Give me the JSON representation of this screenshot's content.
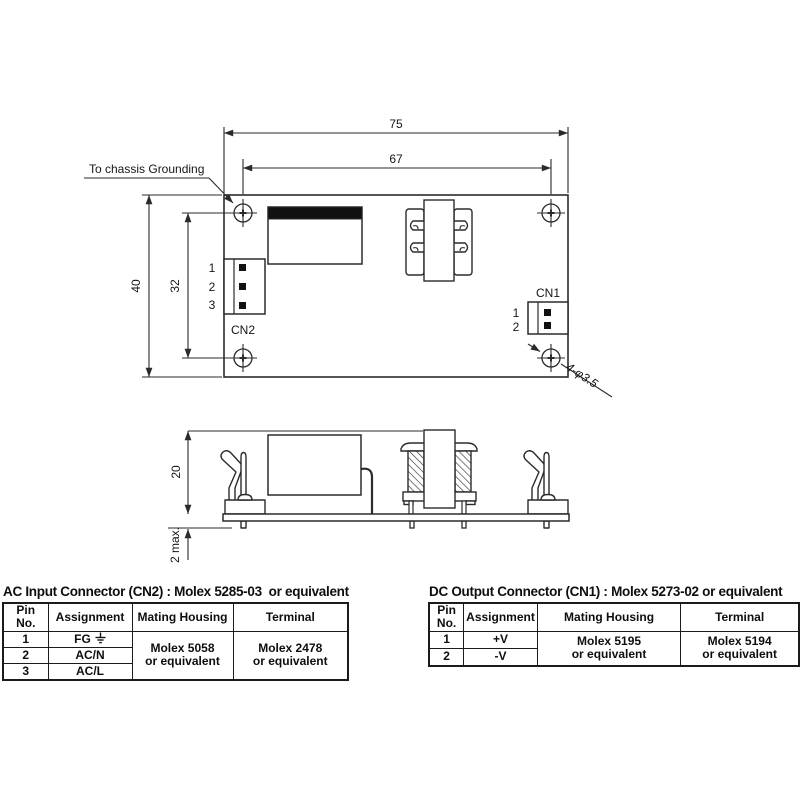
{
  "colors": {
    "line": "#2b2b2b",
    "background": "#ffffff",
    "fill_black": "#111111"
  },
  "top_view": {
    "dims": {
      "outer_width": "75",
      "inner_width": "67",
      "outer_height": "40",
      "inner_height": "32"
    },
    "grounding_label": "To chassis Grounding",
    "holes_label": "4-φ3.5",
    "cn2": {
      "label": "CN2",
      "pins": [
        "1",
        "2",
        "3"
      ]
    },
    "cn1": {
      "label": "CN1",
      "pins": [
        "1",
        "2"
      ]
    }
  },
  "side_view": {
    "dims": {
      "height": "20",
      "pin_protrusion": "2 max."
    }
  },
  "tables": {
    "ac": {
      "title": "AC Input Connector (CN2) : Molex 5285-03  or equivalent",
      "headers": [
        "Pin No.",
        "Assignment",
        "Mating Housing",
        "Terminal"
      ],
      "rows": [
        {
          "pin": "1",
          "assignment": "FG",
          "has_ground_icon": true
        },
        {
          "pin": "2",
          "assignment": "AC/N"
        },
        {
          "pin": "3",
          "assignment": "AC/L"
        }
      ],
      "mating_housing": [
        "Molex 5058",
        "or equivalent"
      ],
      "terminal": [
        "Molex 2478",
        "or equivalent"
      ]
    },
    "dc": {
      "title": "DC Output Connector (CN1) : Molex 5273-02 or equivalent",
      "headers": [
        "Pin No.",
        "Assignment",
        "Mating Housing",
        "Terminal"
      ],
      "rows": [
        {
          "pin": "1",
          "assignment": "+V"
        },
        {
          "pin": "2",
          "assignment": "-V"
        }
      ],
      "mating_housing": [
        "Molex 5195",
        "or equivalent"
      ],
      "terminal": [
        "Molex 5194",
        "or equivalent"
      ]
    }
  }
}
